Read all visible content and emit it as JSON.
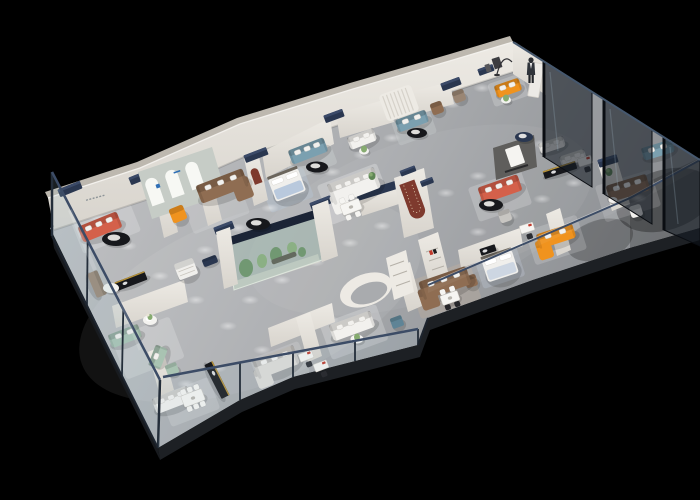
{
  "meta": {
    "description": "3D isometric cutaway render of a furniture showroom floor plan, viewed from above at an angle, floating on a pure black background",
    "view": "axonometric dollhouse cutaway, long axis running lower-left to upper-right",
    "background_color": "#000000"
  },
  "palette": {
    "background": "#000000",
    "floor_mid": "#a9abae",
    "floor_light": "#c6c7c9",
    "floor_dark": "#8b8e92",
    "wall_light": "#edeae4",
    "wall_mid": "#d8d4cd",
    "wall_dark": "#bdb8af",
    "navy_accent": "#2a3750",
    "navy_deep": "#1b2436",
    "glass_rail": "#3c4c66",
    "glass_tint": "#9fc0cd",
    "glass_dark": "#141b24",
    "orange": "#f0931e",
    "coral": "#d4604a",
    "brown": "#8f6d52",
    "taupe": "#9a8674",
    "teal": "#7ba0b0",
    "sage": "#a9c3b2",
    "maroon": "#7e3a2e",
    "plant_green": "#5e8655",
    "plant_green_light": "#86ab70",
    "white_fabric": "#f2f1ee",
    "gray_fabric": "#dedcd8",
    "gray_chair": "#c8c6c2",
    "black_furniture": "#17181c",
    "gold_trim": "#c79f3c",
    "blue_bed": "#b9c9dd",
    "dark_feature_wall": "#5f5e5c",
    "logo_blue": "#2f6fb5",
    "logo_red": "#c0392b"
  },
  "scene": {
    "architecture": [
      "outer-northwest-wall",
      "arched-display-niche-wall",
      "red-arch-niche-wall",
      "red-u-feature-pier",
      "dark-media-tv-wall",
      "indoor-garden-vitrine",
      "curved-white-partition",
      "shelf-wall-with-logo",
      "navy-capped-wall-piers",
      "southwest-glass-facade",
      "front-glass-facade",
      "interior-glass-corridor-wall",
      "northeast-dark-glass-partitions",
      "floor-slab-edge"
    ],
    "furniture": [
      {
        "name": "coral-sofa-left",
        "color": "coral"
      },
      {
        "name": "coffee-table-left",
        "color": "black_furniture"
      },
      {
        "name": "orange-wing-chair",
        "color": "orange"
      },
      {
        "name": "brown-sectional",
        "color": "brown"
      },
      {
        "name": "coffee-table-arches",
        "color": "black_furniture"
      },
      {
        "name": "display-bed-blue",
        "color": "blue_bed"
      },
      {
        "name": "teal-sofa-1",
        "color": "teal"
      },
      {
        "name": "coffee-table-teal-1",
        "color": "black_furniture"
      },
      {
        "name": "white-booth-sofa",
        "color": "white_fabric"
      },
      {
        "name": "teal-sofa-2",
        "color": "teal"
      },
      {
        "name": "coffee-table-teal-2",
        "color": "black_furniture"
      },
      {
        "name": "brown-armchair-top",
        "color": "brown"
      },
      {
        "name": "taupe-armchair-top",
        "color": "taupe"
      },
      {
        "name": "curved-orange-sofa",
        "color": "orange"
      },
      {
        "name": "pedestal-table-corner",
        "color": "white_fabric"
      },
      {
        "name": "white-sectional-mid",
        "color": "white_fabric"
      },
      {
        "name": "dining-set-mid",
        "color": "white_fabric"
      },
      {
        "name": "navy-round-table",
        "color": "navy_accent"
      },
      {
        "name": "coral-sofa-right",
        "color": "coral"
      },
      {
        "name": "coffee-table-right",
        "color": "black_furniture"
      },
      {
        "name": "gray-armchair-right",
        "color": "gray_chair"
      },
      {
        "name": "orange-chaise-sectional",
        "color": "orange"
      },
      {
        "name": "writing-desk-right",
        "color": "white_fabric"
      },
      {
        "name": "brown-sofa-right",
        "color": "brown"
      },
      {
        "name": "white-armchair-right",
        "color": "white_fabric"
      },
      {
        "name": "teal-sofa-far-right",
        "color": "teal"
      },
      {
        "name": "white-sofas-mid-right",
        "color": "white_fabric"
      },
      {
        "name": "black-slat-console-right",
        "color": "black_furniture"
      },
      {
        "name": "display-bed-gray",
        "color": "blue_bed"
      },
      {
        "name": "black-console-bedroom",
        "color": "black_furniture"
      },
      {
        "name": "brown-armchair-bottom",
        "color": "brown"
      },
      {
        "name": "brown-sectional-bottom",
        "color": "brown"
      },
      {
        "name": "dining-set-bottom-right",
        "color": "white_fabric"
      },
      {
        "name": "white-sofa-bottom",
        "color": "white_fabric"
      },
      {
        "name": "plant-table-bottom",
        "color": "white_fabric"
      },
      {
        "name": "teal-ottoman",
        "color": "teal"
      },
      {
        "name": "gray-sectional-bottom",
        "color": "gray_fabric"
      },
      {
        "name": "writing-desks-bottom",
        "color": "white_fabric"
      },
      {
        "name": "sage-sofa-set",
        "color": "sage"
      },
      {
        "name": "flower-side-table",
        "color": "white_fabric"
      },
      {
        "name": "white-sectional-corner",
        "color": "white_fabric"
      },
      {
        "name": "dining-set-bottom-left",
        "color": "white_fabric"
      },
      {
        "name": "black-media-bar",
        "color": "black_furniture"
      },
      {
        "name": "black-console-1",
        "color": "black_furniture"
      },
      {
        "name": "taupe-cabinet",
        "color": "taupe"
      },
      {
        "name": "white-coffee-table-left",
        "color": "white_fabric"
      },
      {
        "name": "white-dresser",
        "color": "white_fabric"
      },
      {
        "name": "store-attendant-figure",
        "color": "black_furniture"
      }
    ],
    "lighting": {
      "ceiling_spotlight_pools_on_floor": 32
    }
  }
}
